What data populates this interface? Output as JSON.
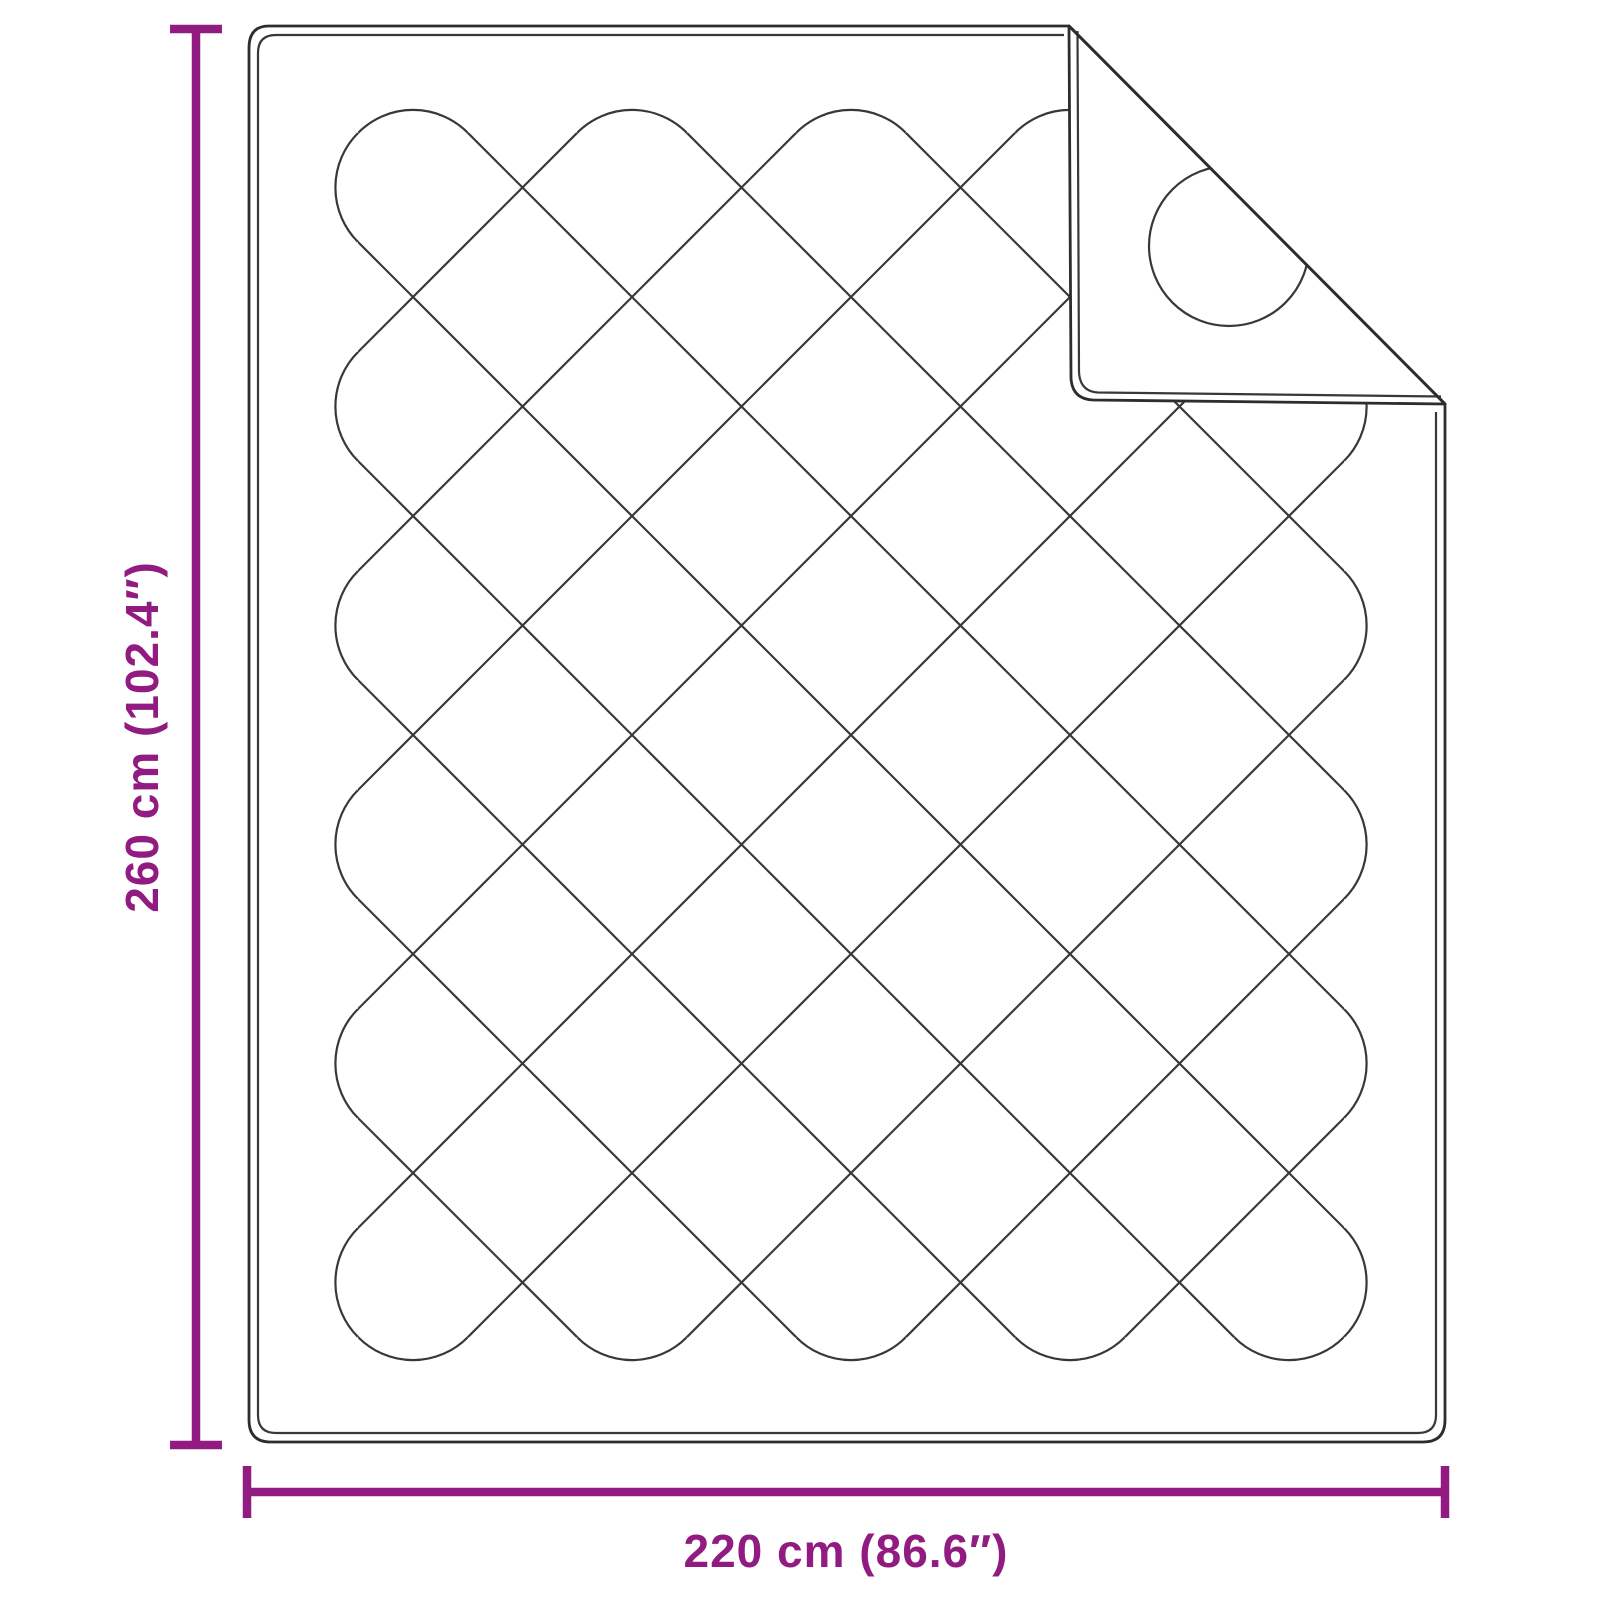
{
  "diagram": {
    "subject": "quilted-blanket-top-view-with-folded-corner",
    "dimensions": {
      "height": {
        "label": "260 cm (102.4″)",
        "cm": 260,
        "inches": 102.4
      },
      "width": {
        "label": "220 cm (86.6″)",
        "cm": 220,
        "inches": 86.6
      }
    },
    "colors": {
      "accent": "#911b80",
      "outline": "#2d2d2d",
      "stitching": "#383838",
      "background": "#ffffff"
    }
  }
}
